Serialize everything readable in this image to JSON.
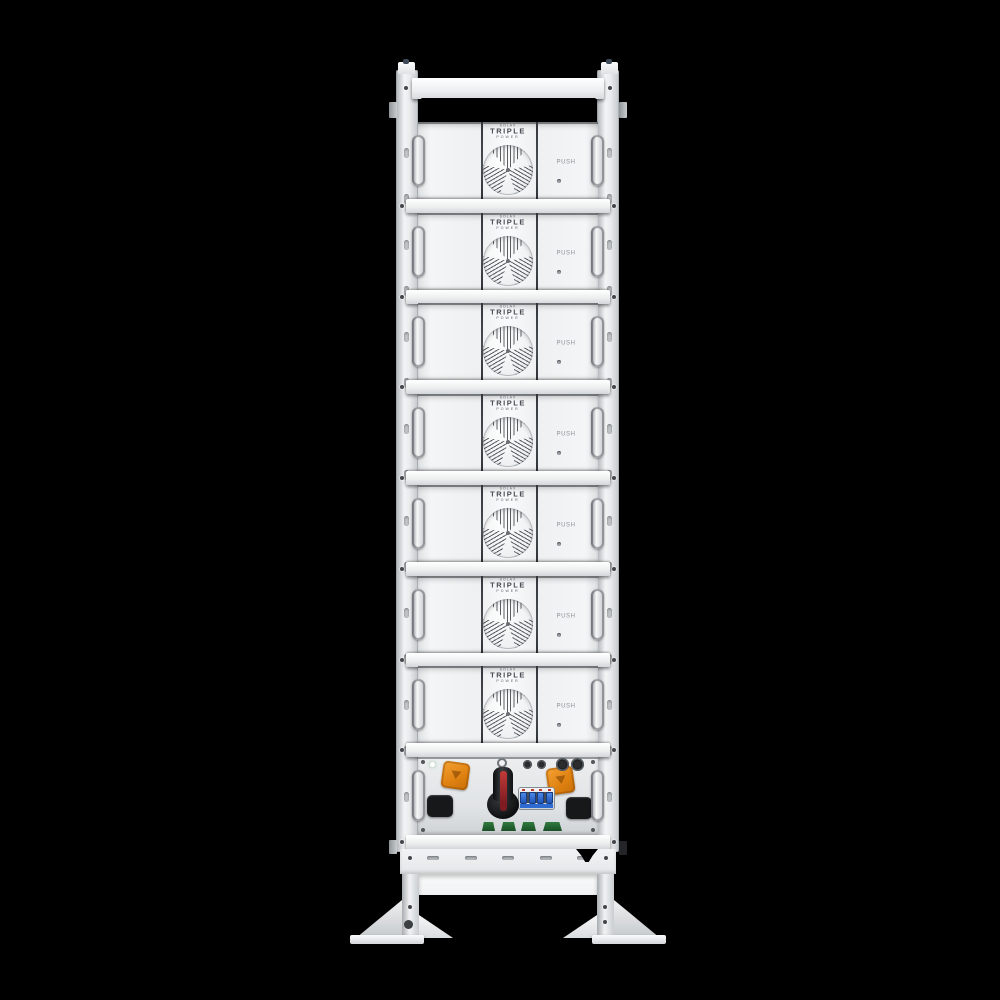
{
  "scene": {
    "background_color": "#000000",
    "subject": "Front view of a white stacked battery tower rack with seven battery modules and a base power control unit on black background"
  },
  "branding": {
    "maker_small": "SOLAX",
    "name_main": "TRIPLE",
    "name_sub": "POWER"
  },
  "module": {
    "count": 7,
    "push_label": "PUSH",
    "features": [
      "fan-grille",
      "brand-logo",
      "push-latch",
      "side-handles"
    ]
  },
  "control_unit": {
    "round_connector_count": 4,
    "breaker_pole_count": 4,
    "green_port_count": 4,
    "parts": [
      "status-led",
      "orange-connector-left",
      "black-port-left",
      "rotary-disconnect-switch",
      "circuit-breaker",
      "round-cable-glands",
      "orange-connector-right",
      "black-port-right",
      "green-comm-ports"
    ]
  },
  "base": {
    "vent_slot_count": 5,
    "parts": [
      "vent-slots",
      "recessed-panel",
      "legs",
      "triangular-feet",
      "base-plates"
    ]
  },
  "colors": {
    "frame_white": "#f2f3f5",
    "divider_dark": "#3f4347",
    "orange_connector": "#e78a1e",
    "breaker_blue": "#2e6bd0",
    "switch_body_black": "#17181b",
    "switch_stripe_red": "#a8262c",
    "green_port": "#27633a"
  }
}
